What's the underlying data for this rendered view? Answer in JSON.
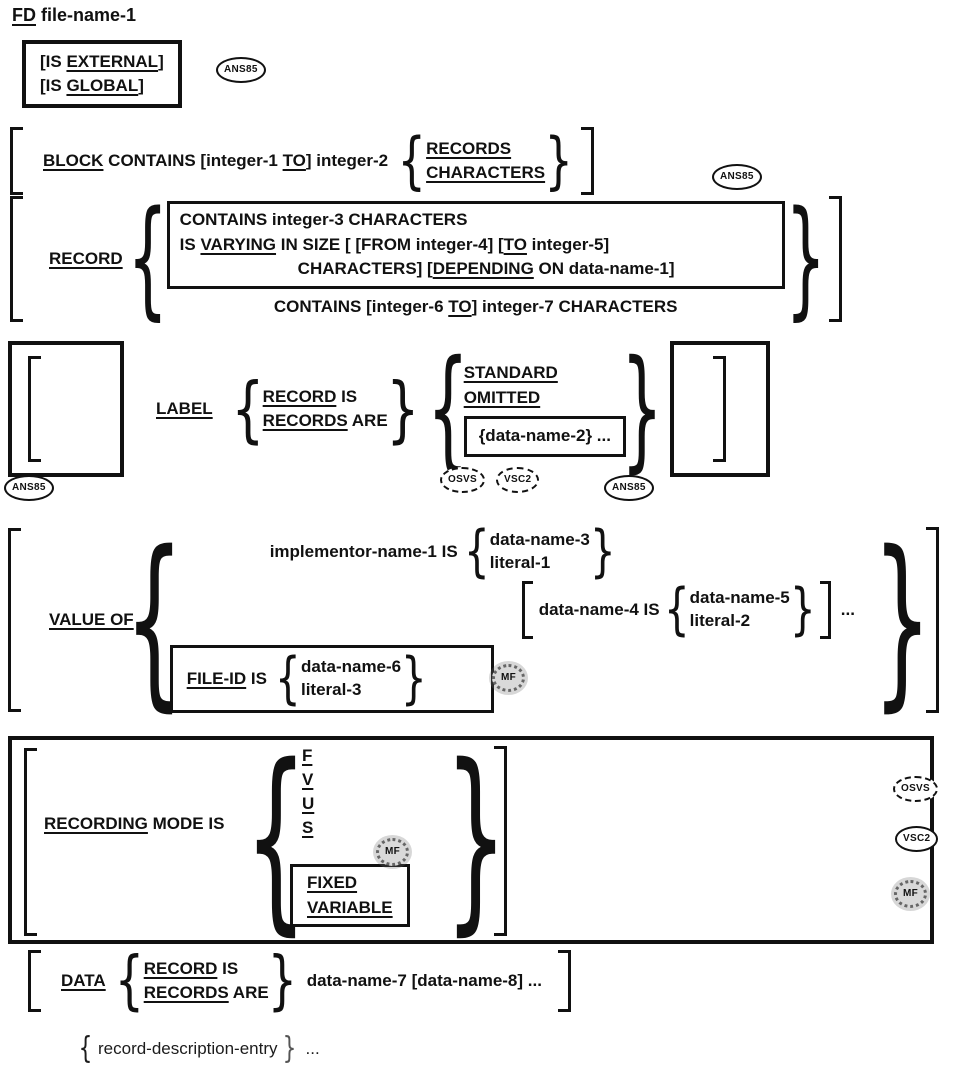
{
  "bubbles": {
    "ans85": "ANS85",
    "osvs": "OSVS",
    "vsc2": "VSC2",
    "mf": "MF"
  },
  "glyphs": {
    "lbrace": "{",
    "rbrace": "}",
    "ellipsis": "..."
  },
  "fd": {
    "kw": "FD",
    "arg": "file-name-1"
  },
  "external_box": {
    "l1_pre": "[IS ",
    "l1_kw": "EXTERNAL",
    "l1_post": "]",
    "l2_pre": "[IS ",
    "l2_kw": "GLOBAL",
    "l2_post": "]"
  },
  "block": {
    "kw": "BLOCK",
    "mid": " CONTAINS [integer-1 ",
    "kw_to": "TO",
    "tail": "] integer-2",
    "opt_records": "RECORDS",
    "opt_characters": "CHARACTERS"
  },
  "record": {
    "kw": "RECORD",
    "l1": "CONTAINS integer-3 CHARACTERS",
    "l2_pre": "IS ",
    "l2_kw1": "VARYING",
    "l2_mid": " IN SIZE [ [FROM integer-4] [",
    "l2_kw2": "TO",
    "l2_post": " integer-5]",
    "l3_pre": "CHARACTERS] [",
    "l3_kw": "DEPENDING",
    "l3_post": " ON data-name-1]",
    "l4_pre": "CONTAINS [integer-6 ",
    "l4_kw": "TO",
    "l4_post": "] integer-7 CHARACTERS"
  },
  "label": {
    "kw": "LABEL",
    "rec_kw": "RECORD",
    "rec_post": " IS",
    "recs_kw": "RECORDS",
    "recs_post": " ARE",
    "standard": "STANDARD",
    "omitted": "OMITTED",
    "dn2": "{data-name-2} ..."
  },
  "value_of": {
    "kw": "VALUE OF",
    "impl": "implementor-name-1 IS",
    "dn3": "data-name-3",
    "lit1": "literal-1",
    "opt_pre": "data-name-4 IS",
    "dn5": "data-name-5",
    "lit2": "literal-2",
    "fileid_kw": "FILE-ID",
    "fileid_post": " IS",
    "dn6": "data-name-6",
    "lit3": "literal-3"
  },
  "recording": {
    "kw": "RECORDING",
    "rest": " MODE IS",
    "f": "F",
    "v": "V",
    "u": "U",
    "s": "S",
    "fixed": "FIXED",
    "variable": "VARIABLE"
  },
  "data_clause": {
    "kw": "DATA",
    "rec_kw": "RECORD",
    "rec_post": " IS",
    "recs_kw": "RECORDS",
    "recs_post": " ARE",
    "args": "data-name-7 [data-name-8] ..."
  },
  "footer": {
    "entry": "record-description-entry"
  }
}
